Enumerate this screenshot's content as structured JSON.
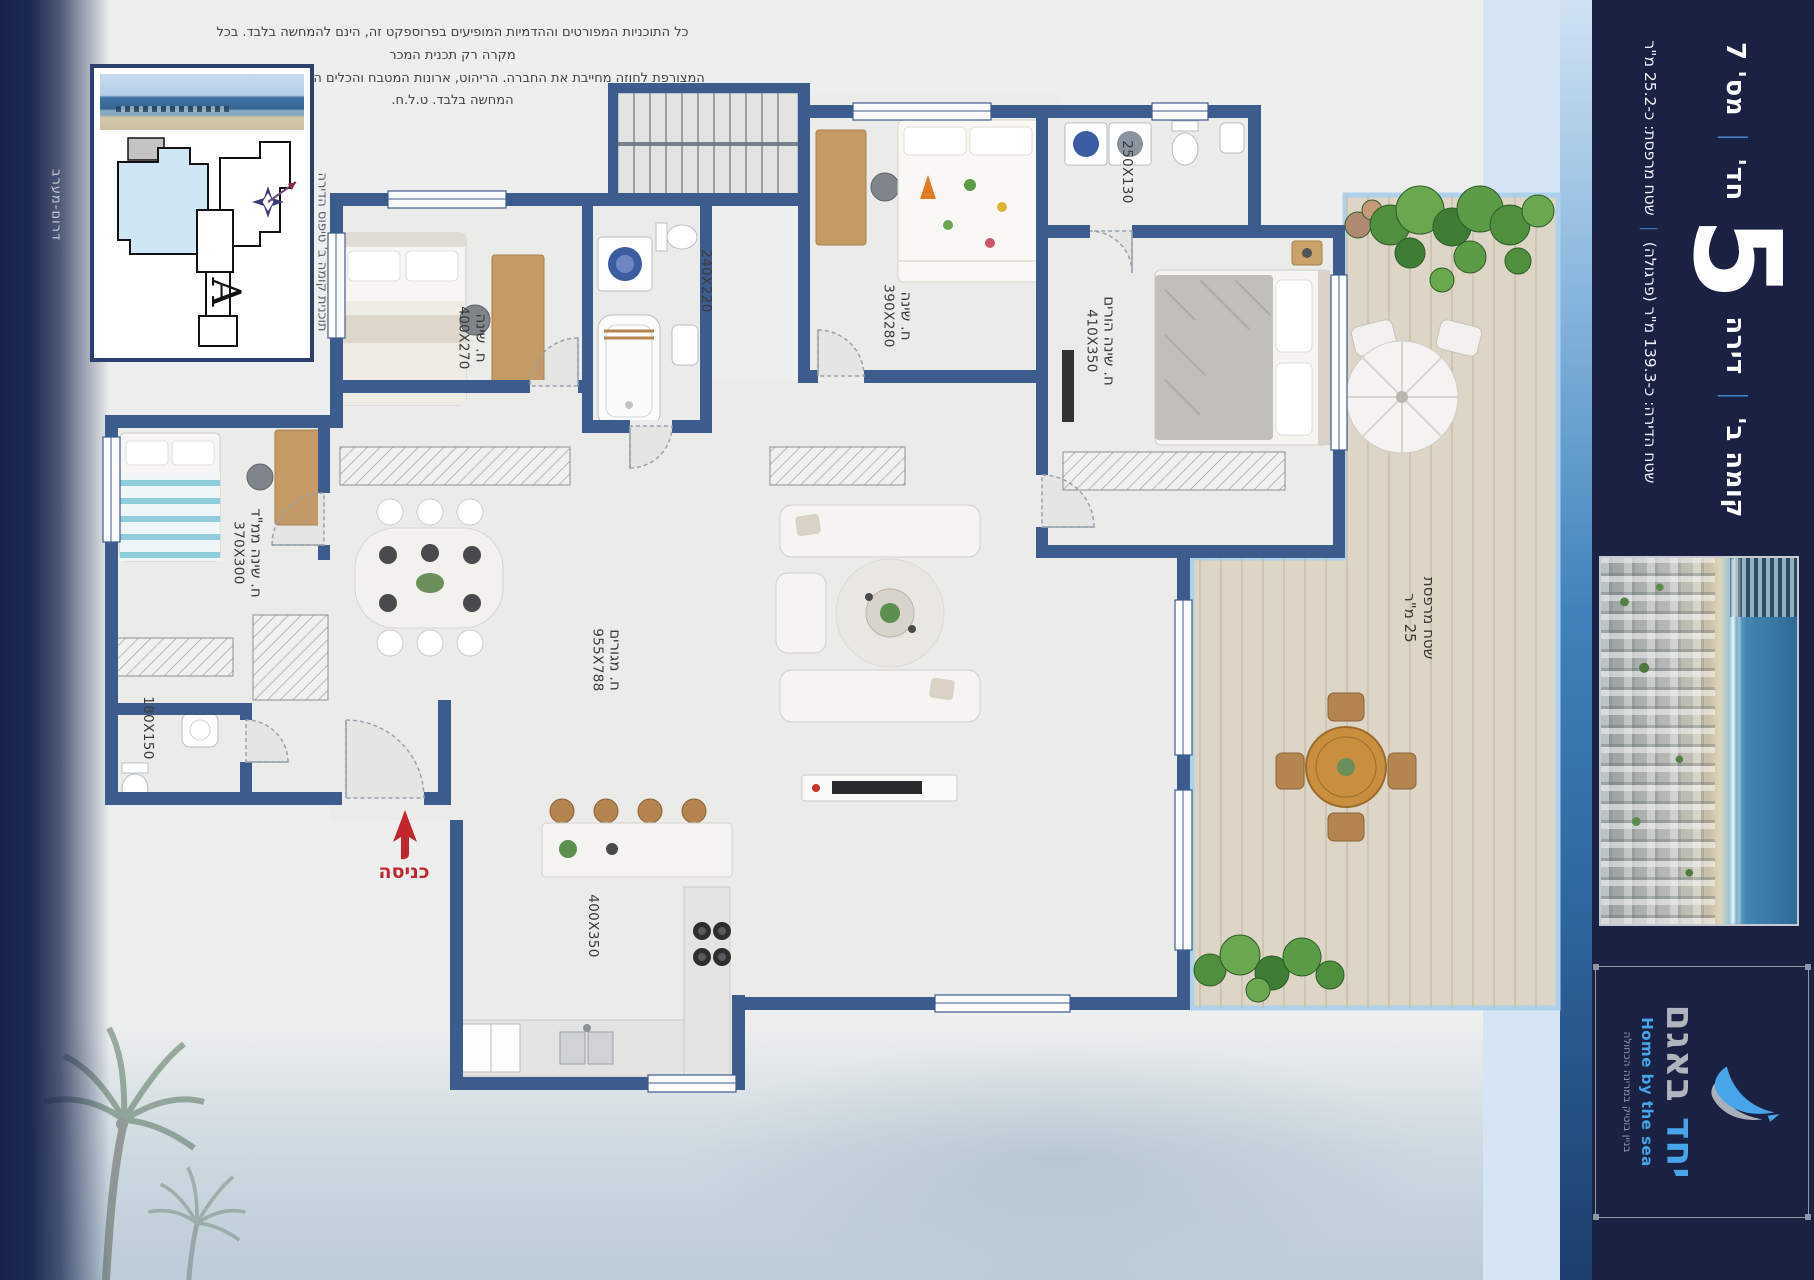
{
  "disclaimer": {
    "line1": "כל התוכניות המפורטים וההדמיות המופיעים בפרוספקט זה, הינם להמחשה בלבד. בכל מקרה רק תכנית המכר",
    "line2": "המצורפת לחוזה מחייבת את החברה. הריהוט, ארונות המטבח והכלים הסניטריים הינם לצורך המחשה בלבד. ט.ל.ח."
  },
  "key_plan": {
    "caption": "תוכנית קומה ב' טיפוס הדירה",
    "orientation": "דרום-מערב",
    "unit_letter": "A"
  },
  "rooms": {
    "bedroom1": {
      "name": "ח. שינה",
      "dims": "400X270"
    },
    "bath1": {
      "dims": "240X220"
    },
    "bedroom2": {
      "name": "ח. שינה",
      "dims": "390X280"
    },
    "service_bath": {
      "dims": "250X130"
    },
    "parents": {
      "name": "ח. שינה הורים",
      "dims": "410X350"
    },
    "mamad": {
      "name": "ח. שינה ממ\"ד",
      "dims": "370X300"
    },
    "bath2": {
      "dims": "180X150"
    },
    "living": {
      "name": "ח. מגורים",
      "dims": "955X788"
    },
    "kitchen": {
      "dims": "400X350"
    },
    "balcony": {
      "name": "שטח מרפסת",
      "dims": "25 מ\"ר"
    }
  },
  "entrance": {
    "label": "כניסה"
  },
  "sidebar": {
    "floor": "קומה ב'",
    "sep": "|",
    "apt_word": "דירה",
    "apt_rooms": "5",
    "apt_rooms_suffix": "חד'",
    "apt_number": "מס' 7",
    "area_apartment": "שטח הדירה: כ-139.3 מ\"ר (פרגולה)",
    "area_balcony": "שטח מרפסת: כ-25.2 מ\"ר"
  },
  "logo": {
    "name_first": "יחד",
    "name_second": "באגם",
    "tagline_en": "Home by the sea",
    "tagline_he": "בניין בוטיק במרינה הכחולה"
  },
  "colors": {
    "wall": "#3d5c8e",
    "sidebar_bg": "#1a2143",
    "accent_blue": "#4a90d9",
    "logo_blue": "#49a5e9",
    "entrance_red": "#c1272d",
    "deck": "#ddd5c6",
    "keyplan_highlight": "#cfe6f5"
  }
}
